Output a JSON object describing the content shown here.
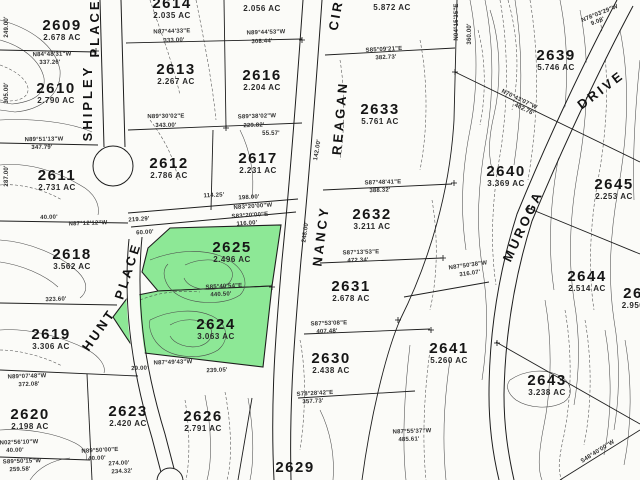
{
  "map": {
    "type": "parcel-plat-map",
    "background": "#fbfbf8",
    "highlight_color": "#8DE896",
    "line_color": "#1e1e1e",
    "highlighted_parcels": [
      "2625",
      "2624"
    ],
    "parcels": [
      {
        "id": "2609",
        "acreage": "2.678 AC",
        "x": 62,
        "y": 30,
        "highlighted": false
      },
      {
        "id": "2614",
        "acreage": "2.035 AC",
        "x": 172,
        "y": 8,
        "highlighted": false,
        "partial": true
      },
      {
        "id": "",
        "acreage": "2.056 AC",
        "x": 262,
        "y": 9,
        "highlighted": false,
        "partial": true
      },
      {
        "id": "",
        "acreage": "5.872 AC",
        "x": 392,
        "y": 8,
        "highlighted": false,
        "partial": true
      },
      {
        "id": "2610",
        "acreage": "2.790 AC",
        "x": 56,
        "y": 93,
        "highlighted": false
      },
      {
        "id": "2613",
        "acreage": "2.267 AC",
        "x": 176,
        "y": 74,
        "highlighted": false
      },
      {
        "id": "2616",
        "acreage": "2.204 AC",
        "x": 262,
        "y": 80,
        "highlighted": false
      },
      {
        "id": "2639",
        "acreage": "5.746 AC",
        "x": 556,
        "y": 60,
        "highlighted": false
      },
      {
        "id": "2633",
        "acreage": "5.761 AC",
        "x": 380,
        "y": 114,
        "highlighted": false
      },
      {
        "id": "2611",
        "acreage": "2.731 AC",
        "x": 57,
        "y": 180,
        "highlighted": false
      },
      {
        "id": "2612",
        "acreage": "2.786 AC",
        "x": 169,
        "y": 168,
        "highlighted": false
      },
      {
        "id": "2617",
        "acreage": "2.231 AC",
        "x": 258,
        "y": 163,
        "highlighted": false
      },
      {
        "id": "2640",
        "acreage": "3.369 AC",
        "x": 506,
        "y": 176,
        "highlighted": false
      },
      {
        "id": "2645",
        "acreage": "2.253 AC",
        "x": 614,
        "y": 189,
        "highlighted": false
      },
      {
        "id": "2632",
        "acreage": "3.211 AC",
        "x": 372,
        "y": 219,
        "highlighted": false
      },
      {
        "id": "2625",
        "acreage": "2.496 AC",
        "x": 232,
        "y": 252,
        "highlighted": true
      },
      {
        "id": "2618",
        "acreage": "3.562 AC",
        "x": 72,
        "y": 259,
        "highlighted": false
      },
      {
        "id": "2631",
        "acreage": "2.678 AC",
        "x": 351,
        "y": 291,
        "highlighted": false
      },
      {
        "id": "2644",
        "acreage": "2.514 AC",
        "x": 587,
        "y": 281,
        "highlighted": false
      },
      {
        "id": "26",
        "acreage": "2.950",
        "x": 633,
        "y": 298,
        "highlighted": false,
        "partial": true
      },
      {
        "id": "2624",
        "acreage": "3.063 AC",
        "x": 216,
        "y": 329,
        "highlighted": true
      },
      {
        "id": "2619",
        "acreage": "3.306 AC",
        "x": 51,
        "y": 339,
        "highlighted": false
      },
      {
        "id": "2641",
        "acreage": "5.260 AC",
        "x": 449,
        "y": 353,
        "highlighted": false
      },
      {
        "id": "2630",
        "acreage": "2.438 AC",
        "x": 331,
        "y": 363,
        "highlighted": false
      },
      {
        "id": "2643",
        "acreage": "3.238 AC",
        "x": 547,
        "y": 385,
        "highlighted": false
      },
      {
        "id": "2620",
        "acreage": "2.198 AC",
        "x": 30,
        "y": 419,
        "highlighted": false
      },
      {
        "id": "2623",
        "acreage": "2.420 AC",
        "x": 128,
        "y": 416,
        "highlighted": false
      },
      {
        "id": "2626",
        "acreage": "2.791 AC",
        "x": 203,
        "y": 421,
        "highlighted": false
      },
      {
        "id": "2629",
        "acreage": "",
        "x": 295,
        "y": 468,
        "highlighted": false,
        "partial": true
      }
    ],
    "streets": [
      {
        "name": "PLACE",
        "x": 95,
        "y": 28,
        "rot": -90
      },
      {
        "name": "SHIPLEY",
        "x": 88,
        "y": 103,
        "rot": -90
      },
      {
        "name": "CIR",
        "x": 336,
        "y": 15,
        "rot": -80
      },
      {
        "name": "REAGAN",
        "x": 340,
        "y": 118,
        "rot": -85
      },
      {
        "name": "NANCY",
        "x": 321,
        "y": 236,
        "rot": -83
      },
      {
        "name": "PLACE",
        "x": 128,
        "y": 271,
        "rot": -72
      },
      {
        "name": "HUNT",
        "x": 99,
        "y": 330,
        "rot": -55
      },
      {
        "name": "MUROGA",
        "x": 523,
        "y": 226,
        "rot": -65
      },
      {
        "name": "DRIVE",
        "x": 601,
        "y": 90,
        "rot": -37
      }
    ],
    "bearings": [
      {
        "text": "N84°48'31\"W",
        "x": 52,
        "y": 55,
        "rot": -1
      },
      {
        "text": "337.26'",
        "x": 50,
        "y": 63,
        "rot": -1
      },
      {
        "text": "N87°44'33\"E",
        "x": 172,
        "y": 32,
        "rot": -2
      },
      {
        "text": "333.00'",
        "x": 174,
        "y": 41,
        "rot": -2
      },
      {
        "text": "N89°44'53\"W",
        "x": 266,
        "y": 33,
        "rot": -2
      },
      {
        "text": "308.44'",
        "x": 262,
        "y": 42,
        "rot": -2
      },
      {
        "text": "S85°09'21\"E",
        "x": 384,
        "y": 50,
        "rot": -3
      },
      {
        "text": "382.73'",
        "x": 386,
        "y": 58,
        "rot": -3
      },
      {
        "text": "N78°03'29\"W",
        "x": 600,
        "y": 14,
        "rot": -22
      },
      {
        "text": "9.08'",
        "x": 598,
        "y": 22,
        "rot": -22
      },
      {
        "text": "249.00'",
        "x": 7,
        "y": 27,
        "rot": -90
      },
      {
        "text": "305.00'",
        "x": 7,
        "y": 93,
        "rot": -90
      },
      {
        "text": "287.00'",
        "x": 7,
        "y": 176,
        "rot": -90
      },
      {
        "text": "N89°51'13\"W",
        "x": 44,
        "y": 140,
        "rot": -1
      },
      {
        "text": "347.79'",
        "x": 42,
        "y": 148,
        "rot": -1
      },
      {
        "text": "N89°30'02\"E",
        "x": 166,
        "y": 117,
        "rot": -1
      },
      {
        "text": "343.00'",
        "x": 166,
        "y": 126,
        "rot": -1
      },
      {
        "text": "S89°38'02\"W",
        "x": 257,
        "y": 117,
        "rot": -2
      },
      {
        "text": "229.82'",
        "x": 254,
        "y": 126,
        "rot": -2
      },
      {
        "text": "55.57'",
        "x": 271,
        "y": 134,
        "rot": 0
      },
      {
        "text": "142.00'",
        "x": 318,
        "y": 150,
        "rot": -80
      },
      {
        "text": "40.00'",
        "x": 49,
        "y": 218,
        "rot": -2
      },
      {
        "text": "N87°12'12\"W",
        "x": 88,
        "y": 224,
        "rot": -2
      },
      {
        "text": "219.29'",
        "x": 139,
        "y": 220,
        "rot": -4
      },
      {
        "text": "60.00'",
        "x": 145,
        "y": 233,
        "rot": -4
      },
      {
        "text": "114.25'",
        "x": 214,
        "y": 196,
        "rot": -3
      },
      {
        "text": "198.00'",
        "x": 249,
        "y": 198,
        "rot": -3
      },
      {
        "text": "N83°20'00\"W",
        "x": 253,
        "y": 207,
        "rot": -4
      },
      {
        "text": "S83°20'00\"E",
        "x": 250,
        "y": 216,
        "rot": -4
      },
      {
        "text": "116.00'",
        "x": 247,
        "y": 224,
        "rot": -4
      },
      {
        "text": "248.00'",
        "x": 306,
        "y": 232,
        "rot": -82
      },
      {
        "text": "S87°48'41\"E",
        "x": 383,
        "y": 183,
        "rot": -2
      },
      {
        "text": "388.32'",
        "x": 380,
        "y": 191,
        "rot": -2
      },
      {
        "text": "S87°13'53\"E",
        "x": 361,
        "y": 253,
        "rot": -2
      },
      {
        "text": "472.34'",
        "x": 358,
        "y": 261,
        "rot": -2
      },
      {
        "text": "N04°15'35\"E",
        "x": 457,
        "y": 22,
        "rot": -90
      },
      {
        "text": "360.00'",
        "x": 470,
        "y": 34,
        "rot": -90
      },
      {
        "text": "N70°43'07\"W",
        "x": 519,
        "y": 100,
        "rot": 26
      },
      {
        "text": "402.76'",
        "x": 524,
        "y": 110,
        "rot": 26
      },
      {
        "text": "N87°50'38\"W",
        "x": 468,
        "y": 266,
        "rot": -8
      },
      {
        "text": "316.07'",
        "x": 470,
        "y": 274,
        "rot": -8
      },
      {
        "text": "323.60'",
        "x": 56,
        "y": 300,
        "rot": -2
      },
      {
        "text": "S85°40'54\"E",
        "x": 224,
        "y": 287,
        "rot": -3
      },
      {
        "text": "440.50'",
        "x": 221,
        "y": 295,
        "rot": -3
      },
      {
        "text": "N89°07'48\"W",
        "x": 27,
        "y": 377,
        "rot": -2
      },
      {
        "text": "372.08'",
        "x": 29,
        "y": 385,
        "rot": -2
      },
      {
        "text": "N87°49'43\"W",
        "x": 173,
        "y": 363,
        "rot": -2
      },
      {
        "text": "239.05'",
        "x": 217,
        "y": 371,
        "rot": -2
      },
      {
        "text": "29.00'",
        "x": 140,
        "y": 369,
        "rot": -2
      },
      {
        "text": "S87°53'08\"E",
        "x": 329,
        "y": 324,
        "rot": -2
      },
      {
        "text": "407.48'",
        "x": 327,
        "y": 332,
        "rot": -2
      },
      {
        "text": "S78°28'42\"E",
        "x": 315,
        "y": 394,
        "rot": -3
      },
      {
        "text": "357.73'",
        "x": 313,
        "y": 402,
        "rot": -3
      },
      {
        "text": "N87°55'37\"W",
        "x": 412,
        "y": 432,
        "rot": -2
      },
      {
        "text": "485.61'",
        "x": 409,
        "y": 440,
        "rot": -2
      },
      {
        "text": "N02°56'10\"W",
        "x": 19,
        "y": 443,
        "rot": -2
      },
      {
        "text": "40.00'",
        "x": 15,
        "y": 451,
        "rot": -2
      },
      {
        "text": "S89°50'15\"W",
        "x": 22,
        "y": 462,
        "rot": -2
      },
      {
        "text": "259.58'",
        "x": 20,
        "y": 470,
        "rot": -2
      },
      {
        "text": "N89°50'00\"E",
        "x": 100,
        "y": 451,
        "rot": -3
      },
      {
        "text": "40.00'",
        "x": 97,
        "y": 459,
        "rot": -3
      },
      {
        "text": "274.00'",
        "x": 119,
        "y": 464,
        "rot": -3
      },
      {
        "text": "234.32'",
        "x": 122,
        "y": 472,
        "rot": -3
      },
      {
        "text": "S48°40'00\"W",
        "x": 598,
        "y": 452,
        "rot": -32
      }
    ]
  }
}
